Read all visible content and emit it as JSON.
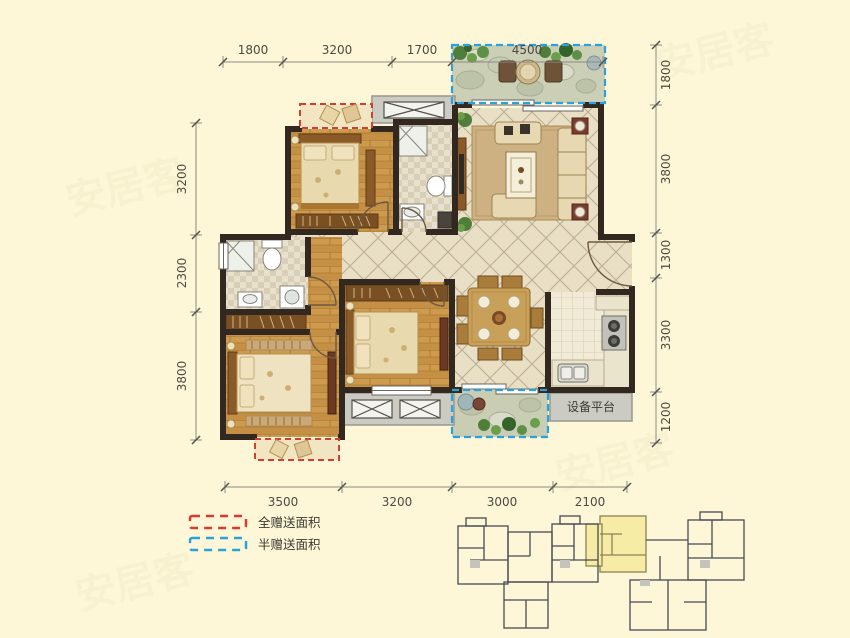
{
  "dimensions": {
    "top": [
      "1800",
      "3200",
      "1700",
      "4500"
    ],
    "left": [
      "3200",
      "2300",
      "3800"
    ],
    "right": [
      "1800",
      "3800",
      "1300",
      "3300",
      "1200"
    ],
    "bottom": [
      "3500",
      "3200",
      "3000",
      "2100"
    ]
  },
  "labels": {
    "equipment_platform": "设备平台"
  },
  "legend": [
    {
      "label": "全赠送面积",
      "color": "#d63c30",
      "style": "red-dashed"
    },
    {
      "label": "半赠送面积",
      "color": "#2aa0dc",
      "style": "blue-dashed"
    }
  ],
  "watermark": "安居客",
  "colors": {
    "background": "#fdf7d8",
    "wall": "#33281f",
    "wood_floor": "#c59045",
    "tile_floor": "#e9dfc4",
    "full_gift_red": "#d63c30",
    "half_gift_blue": "#2aa0dc",
    "platform_gray": "#cbcbc3",
    "highlight_unit": "#f6eca6"
  }
}
